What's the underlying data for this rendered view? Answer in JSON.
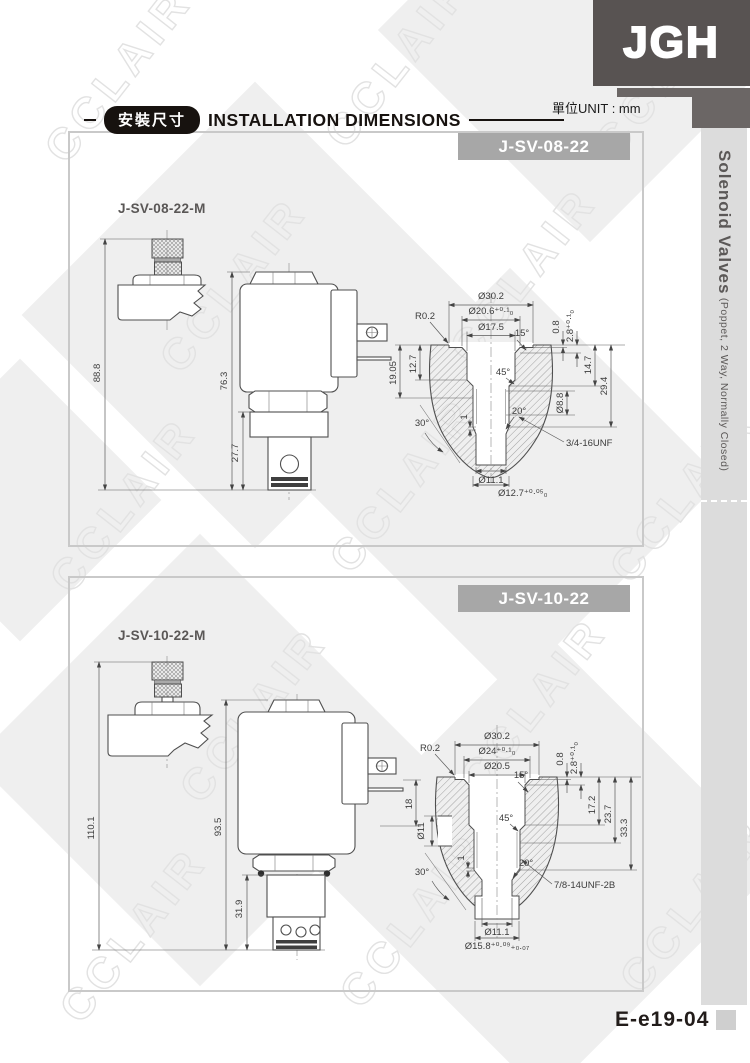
{
  "meta": {
    "unit_note": "單位UNIT : mm",
    "watermark": "CCLAIR"
  },
  "logo": {
    "text": "JGH"
  },
  "header": {
    "badge": "安裝尺寸",
    "title": "INSTALLATION DIMENSIONS"
  },
  "sidebar": {
    "title": "Solenoid Valves",
    "subtitle": " (Poppet, 2 Way, Normally Closed)"
  },
  "footer": {
    "page_code": "E-e19-04"
  },
  "panel1": {
    "banner": "J-SV-08-22",
    "variant": "J-SV-08-22-M",
    "dims": {
      "overall_m": "88.8",
      "overall": "76.3",
      "cartridge": "27.7"
    },
    "cavity": {
      "d302": "Ø30.2",
      "d206": "Ø20.6⁺⁰·¹₀",
      "d175": "Ø17.5",
      "r02": "R0.2",
      "a15": "15°",
      "d08": "0.8",
      "d28": "2.8⁺⁰·¹₀",
      "v1905": "19.05",
      "v127": "12.7",
      "v147": "14.7",
      "v294": "29.4",
      "d88": "Ø8.8",
      "a45": "45°",
      "a20": "20°",
      "a30": "30°",
      "one": "1",
      "thread": "3/4-16UNF",
      "d111": "Ø11.1",
      "d127": "Ø12.7⁺⁰·⁰⁵₀"
    }
  },
  "panel2": {
    "banner": "J-SV-10-22",
    "variant": "J-SV-10-22-M",
    "dims": {
      "overall_m": "110.1",
      "overall": "93.5",
      "cartridge": "31.9",
      "connector": "18"
    },
    "cavity": {
      "d302": "Ø30.2",
      "d24": "Ø24⁺⁰·¹₀",
      "d205": "Ø20.5",
      "r02": "R0.2",
      "a15": "15°",
      "d08": "0.8",
      "d28": "2.8⁺⁰·¹₀",
      "d11": "Ø11",
      "v172": "17.2",
      "v237": "23.7",
      "v333": "33.3",
      "a45": "45°",
      "a20": "20°",
      "a30": "30°",
      "one": "1",
      "thread": "7/8-14UNF-2B",
      "d111": "Ø11.1",
      "d158": "Ø15.8⁺⁰·⁰⁹₊₀.₀₇"
    }
  },
  "colors": {
    "dark": "#585352",
    "banner_gray": "#a7a7a7",
    "sidebar_gray": "#dcdcdc",
    "text_dark": "#3c3c3c"
  }
}
